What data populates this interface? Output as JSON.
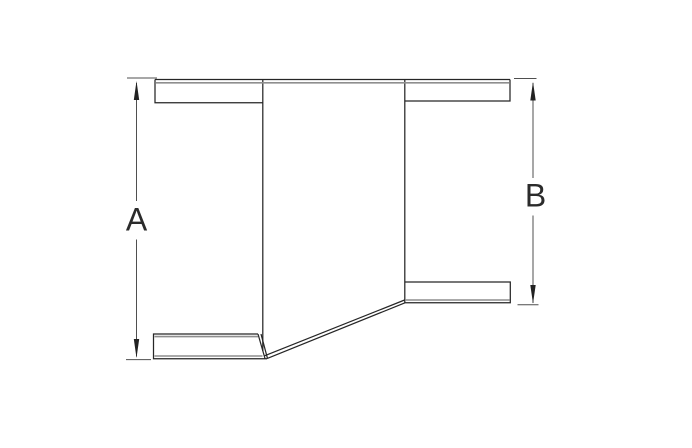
{
  "drawing": {
    "figure": "eccentric-reducer-fitting",
    "dimensions": {
      "a": {
        "label": "A"
      },
      "b": {
        "label": "B"
      }
    },
    "colors": {
      "background": "#ffffff",
      "outline": "#262626",
      "inner_wall": "#8e8e8e",
      "dimension": "#4f4f4f",
      "arrow": "#222222",
      "label": "#2b2b2b"
    }
  }
}
